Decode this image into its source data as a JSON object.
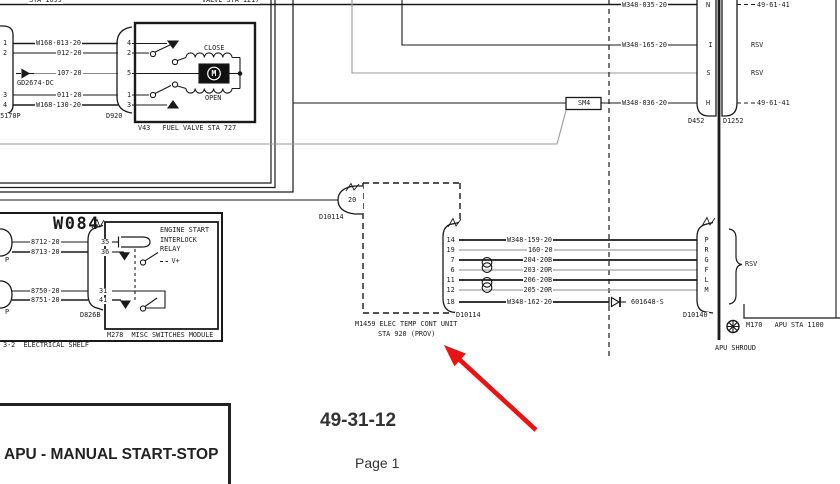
{
  "page": {
    "title_block": "APU - MANUAL START-STOP",
    "section_number": "49-31-12",
    "page_label": "Page 1"
  },
  "top_fragments": {
    "left": "STA 1099",
    "right": "VALVE STA 1217"
  },
  "fuel_valve": {
    "box_label": "V43   FUEL VALVE STA 727",
    "close_label": "CLOSE",
    "open_label": "OPEN",
    "motor_letter": "M",
    "left_connector": {
      "label": "D5170P",
      "pins": [
        "1",
        "2",
        "3",
        "4"
      ]
    },
    "right_connector": {
      "label": "D920",
      "pins": [
        "4",
        "2",
        "5",
        "1",
        "3"
      ]
    },
    "diode_label": "GD2674-DC",
    "wire_labels": [
      "W168-013-20",
      "012-20",
      "107-20",
      "011-20",
      "W168-130-20"
    ]
  },
  "shelf": {
    "bundle_label": "W084",
    "shelf_label": "3-2  ELECTRICAL SHELF",
    "module_label": "M278  MISC SWITCHES MODULE",
    "connector_label": "D826B",
    "plug_top_label": "P",
    "plug_bottom_label": "P",
    "relay_name_lines": [
      "ENGINE START",
      "INTERLOCK",
      "RELAY"
    ],
    "v_plus": "V+",
    "wire_labels": [
      "8712-20",
      "8713-20",
      "8750-20",
      "8751-20"
    ],
    "pins": [
      "35",
      "36",
      "31",
      "41"
    ]
  },
  "firewall": {
    "splice_label": "SM4",
    "dash_note_top": "49-61-41",
    "dash_note_bottom": "49-61-41",
    "rsv_top": "RSV",
    "rsv_bottom": "RSV",
    "left_connector_label": "D452",
    "right_connector_label": "D1252",
    "wire_labels": [
      "W348-035-20",
      "W348-165-20",
      "W348-036-20"
    ],
    "pins": [
      "N",
      "I",
      "S",
      "H"
    ]
  },
  "temp_unit": {
    "name_line1": "M1459 ELEC TEMP CONT UNIT",
    "name_line2": "STA 920 (PROV)",
    "left_pin": "20",
    "left_connector_label": "D10114",
    "right_connector_label": "D10114",
    "pins": [
      "14",
      "19",
      "7",
      "6",
      "11",
      "12",
      "18"
    ],
    "wire_labels": [
      "W348-159-20",
      "160-20",
      "204-20B",
      "203-20R",
      "206-20B",
      "205-20R",
      "W348-162-20"
    ],
    "diode_label": "601648-S"
  },
  "apu": {
    "connector_label": "D10140",
    "pins": [
      "P",
      "R",
      "G",
      "F",
      "L",
      "M"
    ],
    "rsv": "RSV",
    "ground_label": "M170   APU STA 1100",
    "shroud_label": "APU SHROUD"
  }
}
